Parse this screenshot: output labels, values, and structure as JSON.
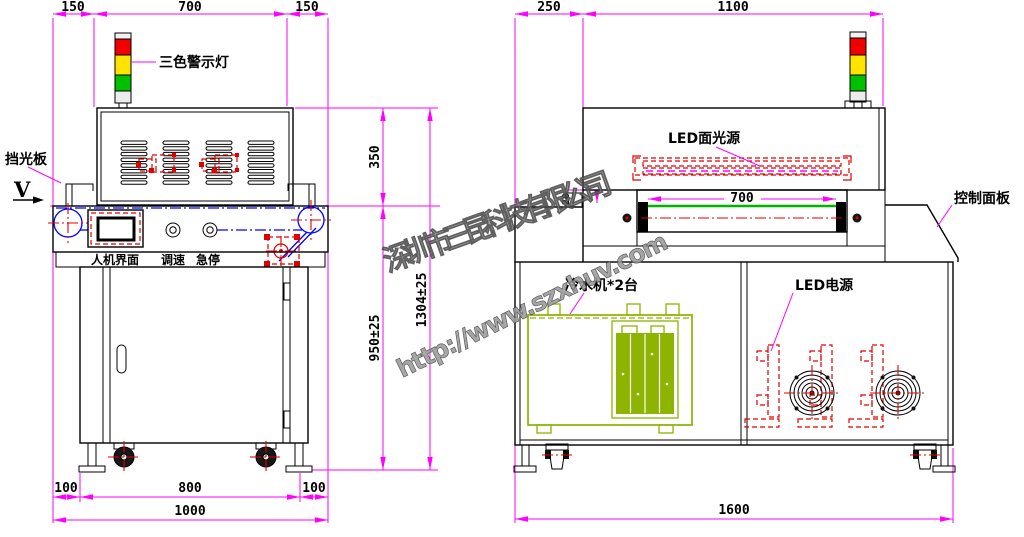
{
  "watermark": {
    "company": "深圳市三昆科技有限公司",
    "url": "http://www.szxhuv.com"
  },
  "front_view": {
    "dims": {
      "top_left": "150",
      "top_mid": "700",
      "top_right": "150",
      "hood_h": "350",
      "body_h": "950±25",
      "total_h": "1304±25",
      "bot_left": "100",
      "bot_mid": "800",
      "bot_right": "100",
      "total_w": "1000"
    },
    "labels": {
      "warning_light": "三色警示灯",
      "light_shield": "挡光板",
      "view_dir": "V",
      "hmi": "人机界面",
      "speed": "调速",
      "estop": "急停"
    }
  },
  "side_view": {
    "dims": {
      "left_ext": "250",
      "hood_w": "1100",
      "belt_w": "700",
      "shield_t": "20",
      "total_w": "1600"
    },
    "labels": {
      "led_source": "LED面光源",
      "control_panel": "控制面板",
      "chiller": "冷水机*2台",
      "led_power": "LED电源"
    }
  },
  "colors": {
    "dimension": "#ff00ff",
    "outline": "#000000",
    "accent_red": "#e00000",
    "accent_blue": "#0000ff",
    "chiller_green": "#8cb400",
    "belt_green": "#00b400",
    "light_red": "#f00000",
    "light_yellow": "#ffe400",
    "light_green": "#00c000"
  }
}
